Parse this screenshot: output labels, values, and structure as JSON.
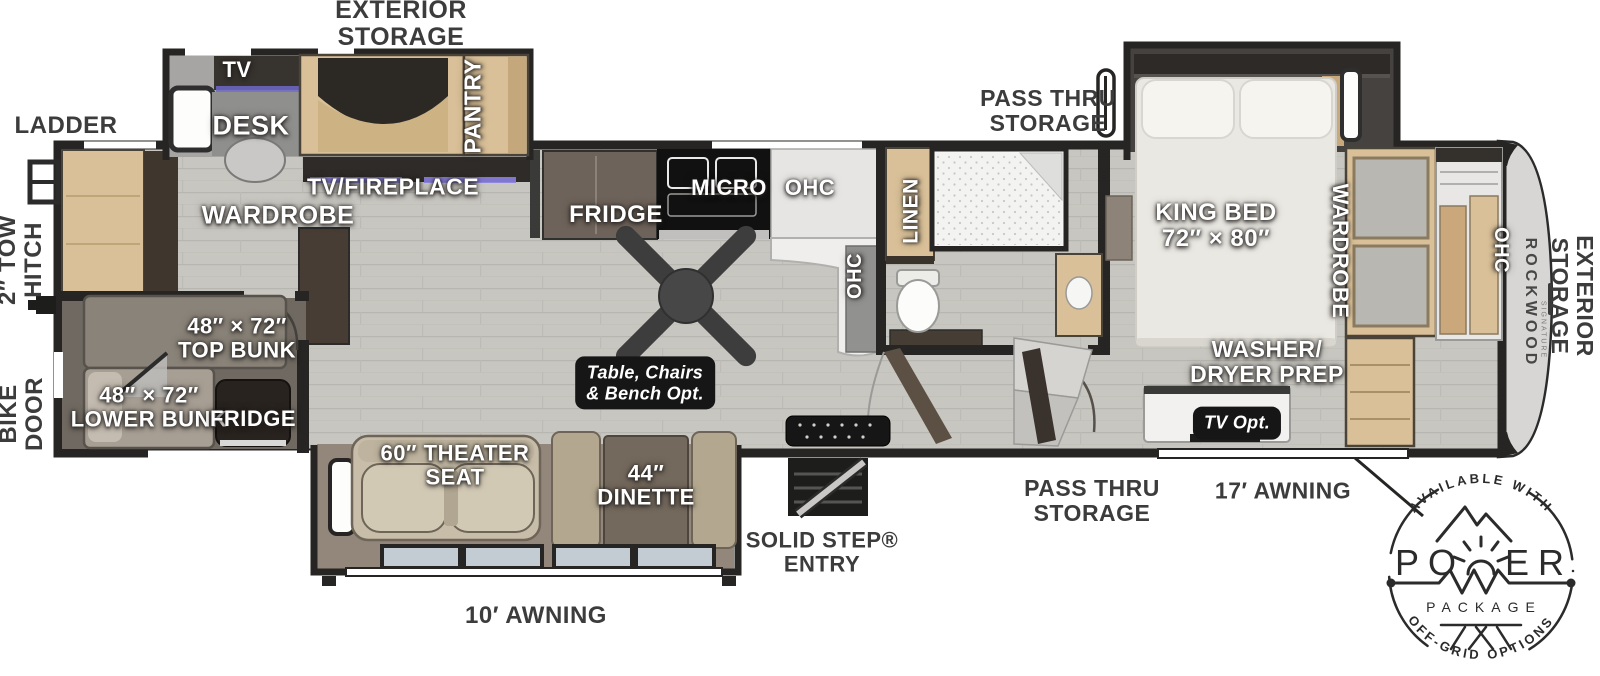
{
  "title": "Rockwood fifth wheel RV floor plan",
  "colors": {
    "label_dark": "#3c3c3c",
    "label_light": "#ffffff",
    "wall": "#262523",
    "floor": "#c8c6c0",
    "wood_light": "#d9c098",
    "wood_dark": "#473d34",
    "tag_bg": "#161616",
    "badge_line": "#2b2b2b"
  },
  "exterior": {
    "storage_top": "EXTERIOR\nSTORAGE",
    "ladder": "LADDER",
    "tow_hitch": "2″ TOW\nHITCH",
    "bike_door": "BIKE\nDOOR",
    "pass_thru_top": "PASS THRU\nSTORAGE",
    "pass_thru_bottom": "PASS THRU\nSTORAGE",
    "awning_17": "17′ AWNING",
    "awning_10": "10′ AWNING",
    "solid_step": "SOLID STEP®\nENTRY",
    "storage_right": "EXTERIOR\nSTORAGE"
  },
  "rooms": {
    "tv": "TV",
    "desk": "DESK",
    "pantry": "PANTRY",
    "tv_fireplace": "TV/FIREPLACE",
    "wardrobe_rear": "WARDROBE",
    "top_bunk": "48″ × 72″\nTOP BUNK",
    "lower_bunk": "48″ × 72″\nLOWER BUNK",
    "bunk_fridge": "FRIDGE",
    "fridge": "FRIDGE",
    "micro": "MICRO",
    "ohc_kitchen": "OHC",
    "ohc_island": "OHC",
    "linen": "LINEN",
    "king_bed": "KING BED\n72″ × 80″",
    "wardrobe_bedroom": "WARDROBE",
    "washer_dryer": "WASHER/\nDRYER PREP",
    "theater_seat": "60″ THEATER\nSEAT",
    "dinette": "44″\nDINETTE",
    "ohc_front": "OHC"
  },
  "options": {
    "table_chairs": "Table, Chairs\n& Bench Opt.",
    "tv_opt": "TV Opt."
  },
  "brand": {
    "name": "ROCKWOOD",
    "series": "SIGNATURE"
  },
  "badge": {
    "available": "AVAILABLE WITH",
    "power_left": "PO",
    "power_right": "ER",
    "package": "PACKAGE",
    "offgrid": "OFF-GRID OPTIONS"
  }
}
